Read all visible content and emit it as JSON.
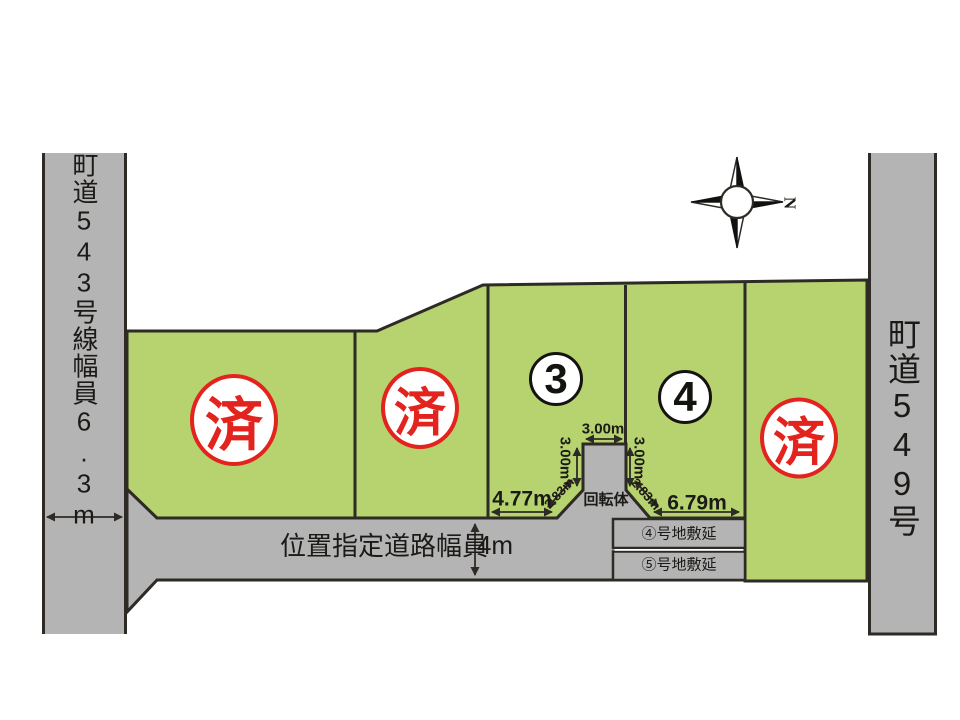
{
  "roads": {
    "left": {
      "label": "町道543号線幅員6.3m"
    },
    "right": {
      "label": "町道549号"
    },
    "front": {
      "label": "位置指定道路幅員",
      "width": "4m"
    }
  },
  "plots": {
    "plot1_status": "済",
    "plot2_status": "済",
    "plot3_number": "3",
    "plot4_number": "4",
    "plot5_status": "済"
  },
  "turning_area": {
    "label": "回転体"
  },
  "dimensions": {
    "turnaround_top_width": "3.00m",
    "turnaround_left_depth": "3.00m",
    "turnaround_right_depth": "3.00m",
    "turnaround_left_slope": "2.83m",
    "turnaround_right_slope": "2.83m",
    "plot3_frontage": "4.77m",
    "plot4_frontage": "6.79m"
  },
  "extensions": {
    "plot4": "④号地敷延",
    "plot5": "⑤号地敷延"
  },
  "compass": {
    "north": "N"
  },
  "colors": {
    "plot-green": "#b6d36f",
    "road-gray": "#b4b4b4",
    "line-dark": "#2e2a25",
    "stamp-red": "#e3231e"
  }
}
